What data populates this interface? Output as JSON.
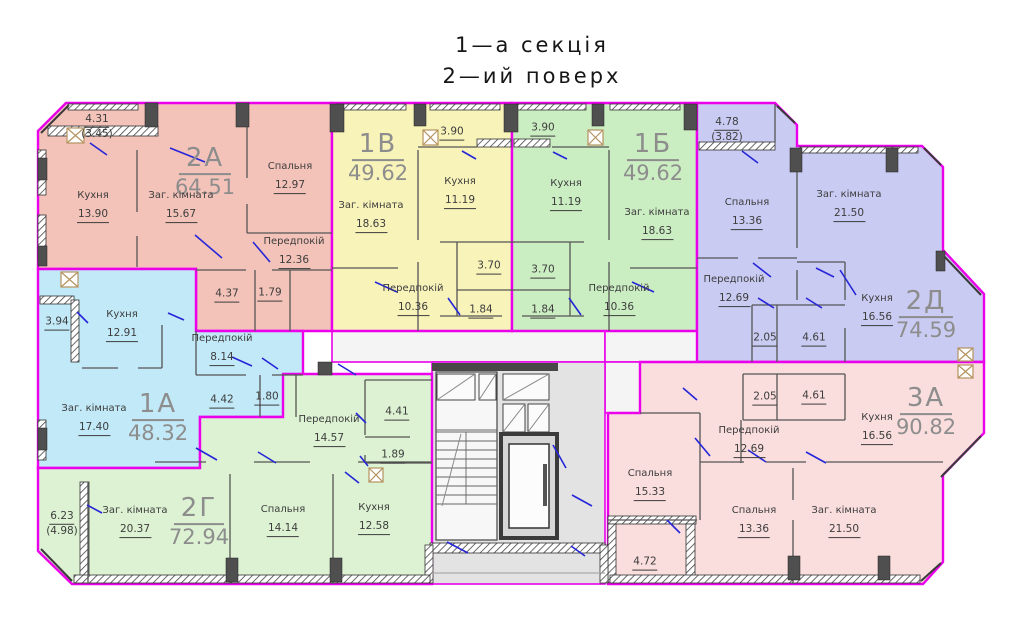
{
  "title": {
    "section": "1—а секція",
    "floor": "2—ий поверх"
  },
  "colors": {
    "outline": "#ea00ea",
    "door": "#2626d8",
    "walls": "#555555",
    "core_fill": "#e3e3e3",
    "hall_fill": "#f4f4f4",
    "stair_fill": "#f7f7f7",
    "vent_box": "#b5935f"
  },
  "apartments": [
    {
      "id": "2А",
      "total": "64.51",
      "color": "#f3c3b9",
      "balcony": {
        "area": "4.31",
        "reduced": "(3.45)"
      },
      "bath": "4.37",
      "wc": "1.79",
      "rooms": [
        {
          "name": "Кухня",
          "area": "13.90"
        },
        {
          "name": "Заг. кімната",
          "area": "15.67"
        },
        {
          "name": "Спальня",
          "area": "12.97"
        },
        {
          "name": "Передпокій",
          "area": "12.36"
        }
      ]
    },
    {
      "id": "1В",
      "total": "49.62",
      "color": "#f8f3b9",
      "balcony": {
        "area": "3.90"
      },
      "bath": "3.70",
      "wc": "1.84",
      "rooms": [
        {
          "name": "Кухня",
          "area": "11.19"
        },
        {
          "name": "Заг. кімната",
          "area": "18.63"
        },
        {
          "name": "Передпокій",
          "area": "10.36"
        }
      ]
    },
    {
      "id": "1Б",
      "total": "49.62",
      "color": "#cbedc2",
      "balcony": {
        "area": "3.90"
      },
      "bath": "3.70",
      "wc": "1.84",
      "rooms": [
        {
          "name": "Кухня",
          "area": "11.19"
        },
        {
          "name": "Заг. кімната",
          "area": "18.63"
        },
        {
          "name": "Передпокій",
          "area": "10.36"
        }
      ]
    },
    {
      "id": "2Д",
      "total": "74.59",
      "color": "#c9cbf2",
      "balcony": {
        "area": "4.78",
        "reduced": "(3.82)"
      },
      "bath": "2.05",
      "wc": "4.61",
      "rooms": [
        {
          "name": "Спальня",
          "area": "13.36"
        },
        {
          "name": "Заг. кімната",
          "area": "21.50"
        },
        {
          "name": "Передпокій",
          "area": "12.69"
        },
        {
          "name": "Кухня",
          "area": "16.56"
        }
      ]
    },
    {
      "id": "1А",
      "total": "48.32",
      "color": "#c2e9f7",
      "balcony": {
        "area": "3.94"
      },
      "bath": "4.42",
      "wc": "1.80",
      "rooms": [
        {
          "name": "Кухня",
          "area": "12.91"
        },
        {
          "name": "Передпокій",
          "area": "8.14"
        },
        {
          "name": "Заг. кімната",
          "area": "17.40"
        }
      ]
    },
    {
      "id": "2Г",
      "total": "72.94",
      "color": "#dcf2d2",
      "balcony": {
        "area": "6.23",
        "reduced": "(4.98)"
      },
      "bath": "4.41",
      "wc": "1.89",
      "rooms": [
        {
          "name": "Заг. кімната",
          "area": "20.37"
        },
        {
          "name": "Спальня",
          "area": "14.14"
        },
        {
          "name": "Кухня",
          "area": "12.58"
        },
        {
          "name": "Передпокій",
          "area": "14.57"
        }
      ]
    },
    {
      "id": "3А",
      "total": "90.82",
      "color": "#fadddd",
      "balcony": {
        "area": "4.72"
      },
      "bath": "2.05",
      "wc": "4.61",
      "rooms": [
        {
          "name": "Спальня",
          "area": "15.33"
        },
        {
          "name": "Передпокій",
          "area": "12.69"
        },
        {
          "name": "Кухня",
          "area": "16.56"
        },
        {
          "name": "Спальня",
          "area": "13.36"
        },
        {
          "name": "Заг. кімната",
          "area": "21.50"
        }
      ]
    }
  ]
}
